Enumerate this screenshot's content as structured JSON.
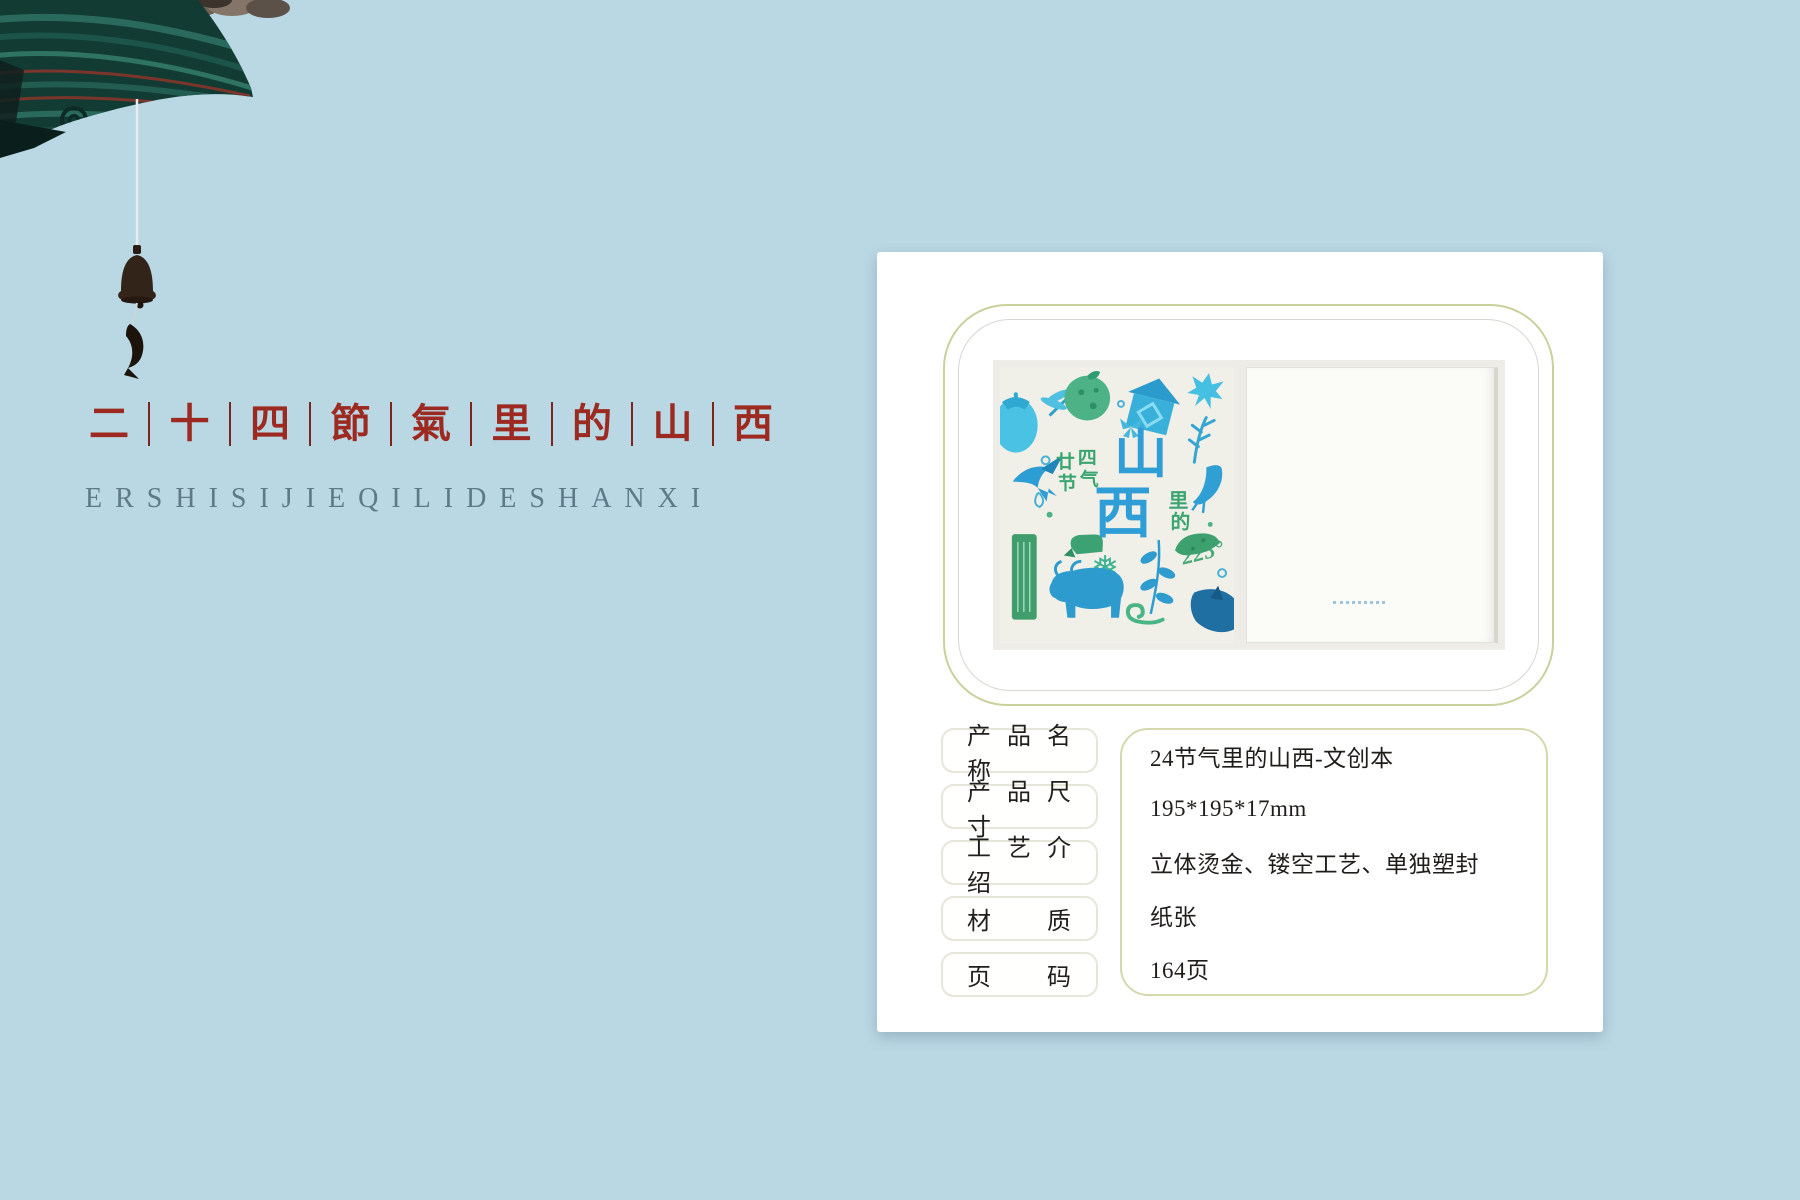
{
  "colors": {
    "page_background": "#b9d8e4",
    "title_red": "#9d2a20",
    "pinyin_gray": "#5e7987",
    "olive_border": "#cad09b",
    "value_box_border": "#d5d8ac",
    "cover_blue": "#2f9ed6",
    "cover_green": "#3aa571"
  },
  "hero": {
    "title_chars": [
      "二",
      "十",
      "四",
      "節",
      "氣",
      "里",
      "的",
      "山",
      "西"
    ],
    "subtitle": "ERSHISIJIEQILIDESHANXI"
  },
  "cover": {
    "year_chars": [
      "廿",
      "四",
      "节",
      "气"
    ],
    "title_chars": [
      "山",
      "西"
    ],
    "label_chars": [
      "里",
      "的"
    ],
    "degree": "225°",
    "snowflake_glyph": "❅"
  },
  "specs": {
    "rows": [
      {
        "label": "产 品 名 称",
        "value": "24节气里的山西-文创本"
      },
      {
        "label": "产 品 尺 寸",
        "value": "195*195*17mm"
      },
      {
        "label": "工 艺 介 绍",
        "value": "立体烫金、镂空工艺、单独塑封"
      },
      {
        "label": "材 质",
        "value": "纸张"
      },
      {
        "label": "页 码",
        "value": "164页"
      }
    ]
  }
}
